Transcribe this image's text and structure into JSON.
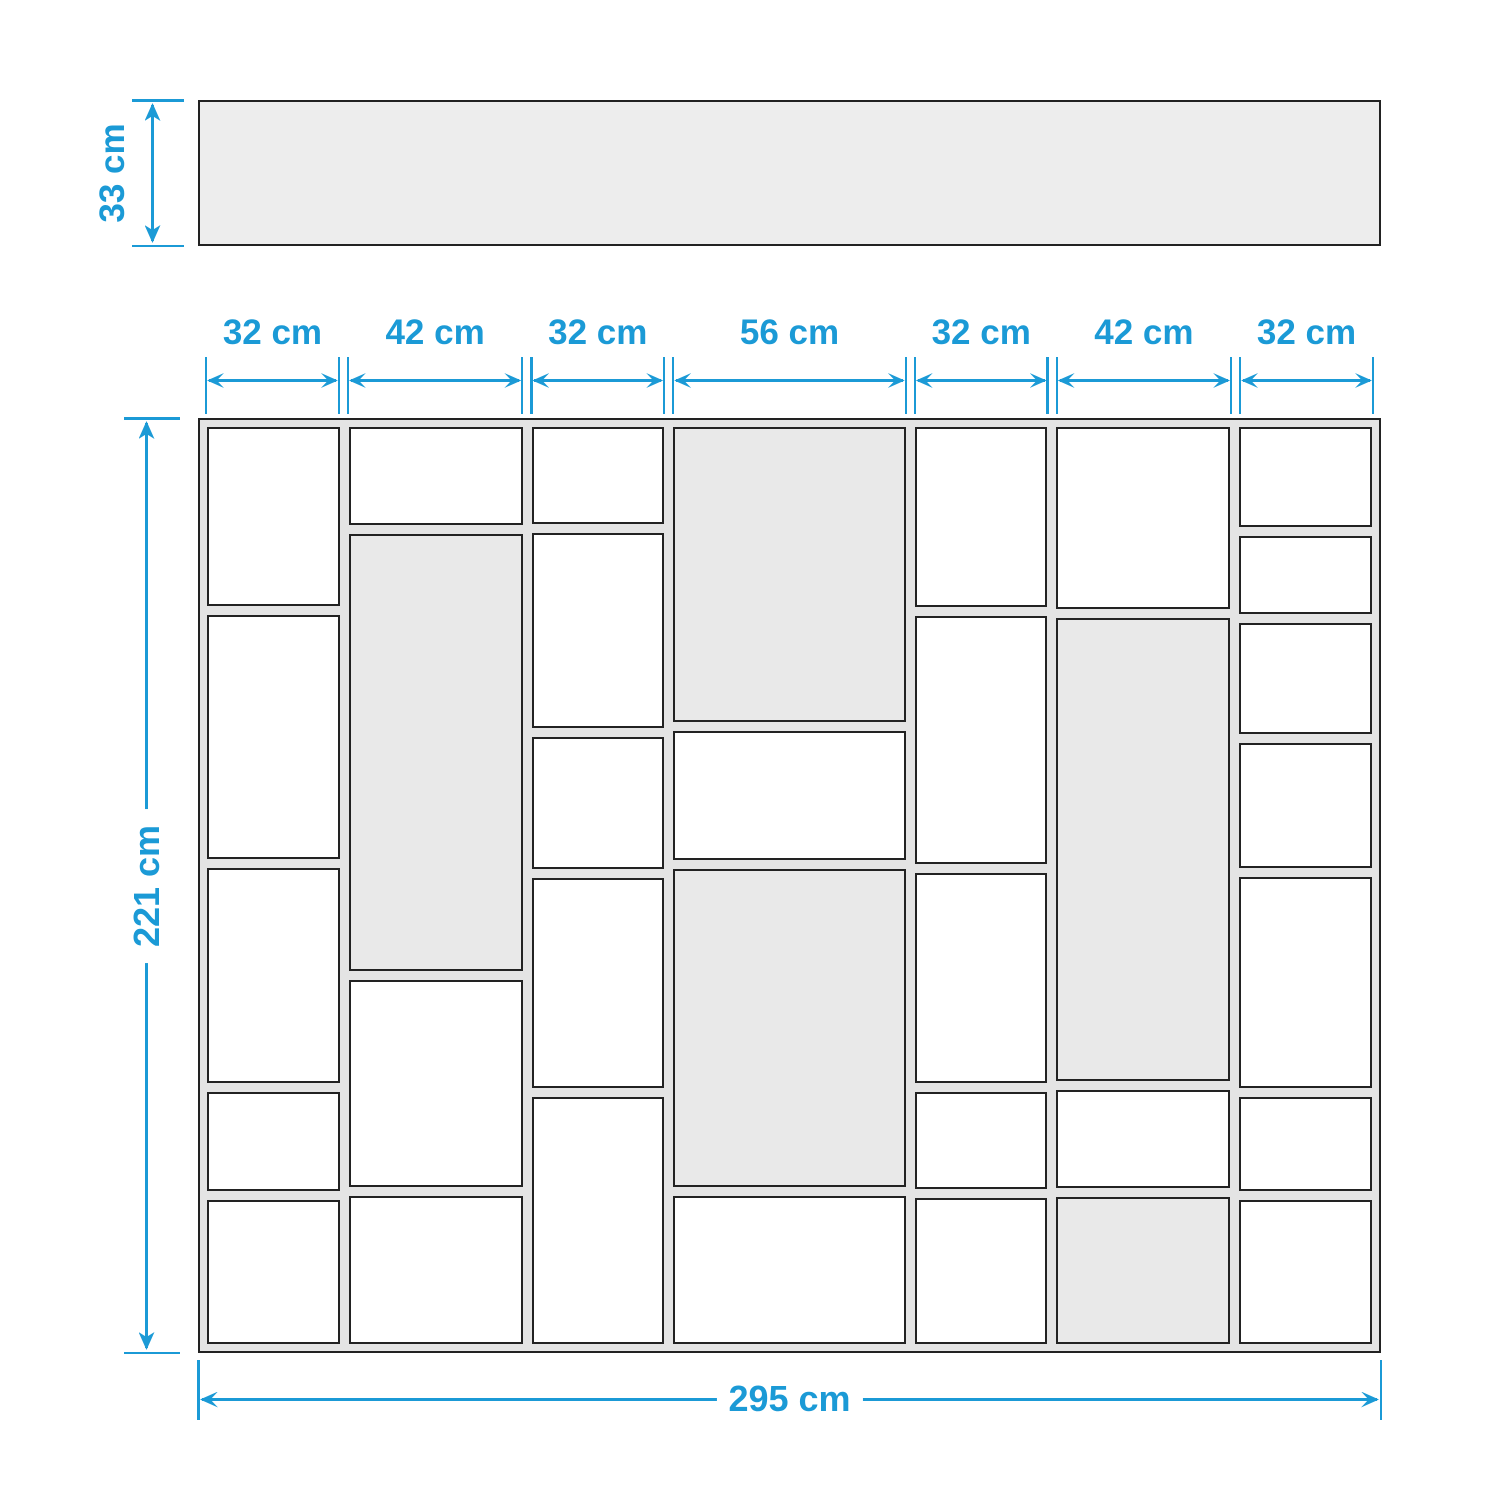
{
  "diagram": {
    "colors": {
      "accent": "#1b9ad6",
      "outline": "#222222",
      "panel_fill": "#e4e4e4",
      "shaded_cell_fill": "#e9e9e9",
      "top_panel_fill": "#ededed",
      "background": "#ffffff"
    },
    "top_view_panel": {
      "depth_label": "33 cm"
    },
    "overall_height": {
      "label": "221 cm"
    },
    "overall_width": {
      "label": "295 cm"
    },
    "columns": [
      {
        "width_label": "32 cm",
        "width_cm": 32,
        "cells": [
          {
            "height": 179,
            "shaded": false
          },
          {
            "height": 245,
            "shaded": false
          },
          {
            "height": 215,
            "shaded": false
          },
          {
            "height": 97,
            "shaded": false
          },
          {
            "height": 143,
            "shaded": false
          }
        ]
      },
      {
        "width_label": "42 cm",
        "width_cm": 42,
        "cells": [
          {
            "height": 95,
            "shaded": false
          },
          {
            "height": 439,
            "shaded": true
          },
          {
            "height": 205,
            "shaded": false
          },
          {
            "height": 146,
            "shaded": false
          }
        ]
      },
      {
        "width_label": "32 cm",
        "width_cm": 32,
        "cells": [
          {
            "height": 95,
            "shaded": false
          },
          {
            "height": 195,
            "shaded": false
          },
          {
            "height": 130,
            "shaded": false
          },
          {
            "height": 210,
            "shaded": false
          },
          {
            "height": 248,
            "shaded": false
          }
        ]
      },
      {
        "width_label": "56 cm",
        "width_cm": 56,
        "cells": [
          {
            "height": 295,
            "shaded": true
          },
          {
            "height": 127,
            "shaded": false
          },
          {
            "height": 319,
            "shaded": true
          },
          {
            "height": 146,
            "shaded": false
          }
        ]
      },
      {
        "width_label": "32 cm",
        "width_cm": 32,
        "cells": [
          {
            "height": 179,
            "shaded": false
          },
          {
            "height": 249,
            "shaded": false
          },
          {
            "height": 210,
            "shaded": false
          },
          {
            "height": 95,
            "shaded": false
          },
          {
            "height": 145,
            "shaded": false
          }
        ]
      },
      {
        "width_label": "42 cm",
        "width_cm": 42,
        "cells": [
          {
            "height": 180,
            "shaded": false
          },
          {
            "height": 464,
            "shaded": true
          },
          {
            "height": 95,
            "shaded": false
          },
          {
            "height": 145,
            "shaded": true
          }
        ]
      },
      {
        "width_label": "32 cm",
        "width_cm": 32,
        "cells": [
          {
            "height": 99,
            "shaded": false
          },
          {
            "height": 77,
            "shaded": false
          },
          {
            "height": 110,
            "shaded": false
          },
          {
            "height": 125,
            "shaded": false
          },
          {
            "height": 214,
            "shaded": false
          },
          {
            "height": 93,
            "shaded": false
          },
          {
            "height": 145,
            "shaded": false
          }
        ]
      }
    ]
  }
}
